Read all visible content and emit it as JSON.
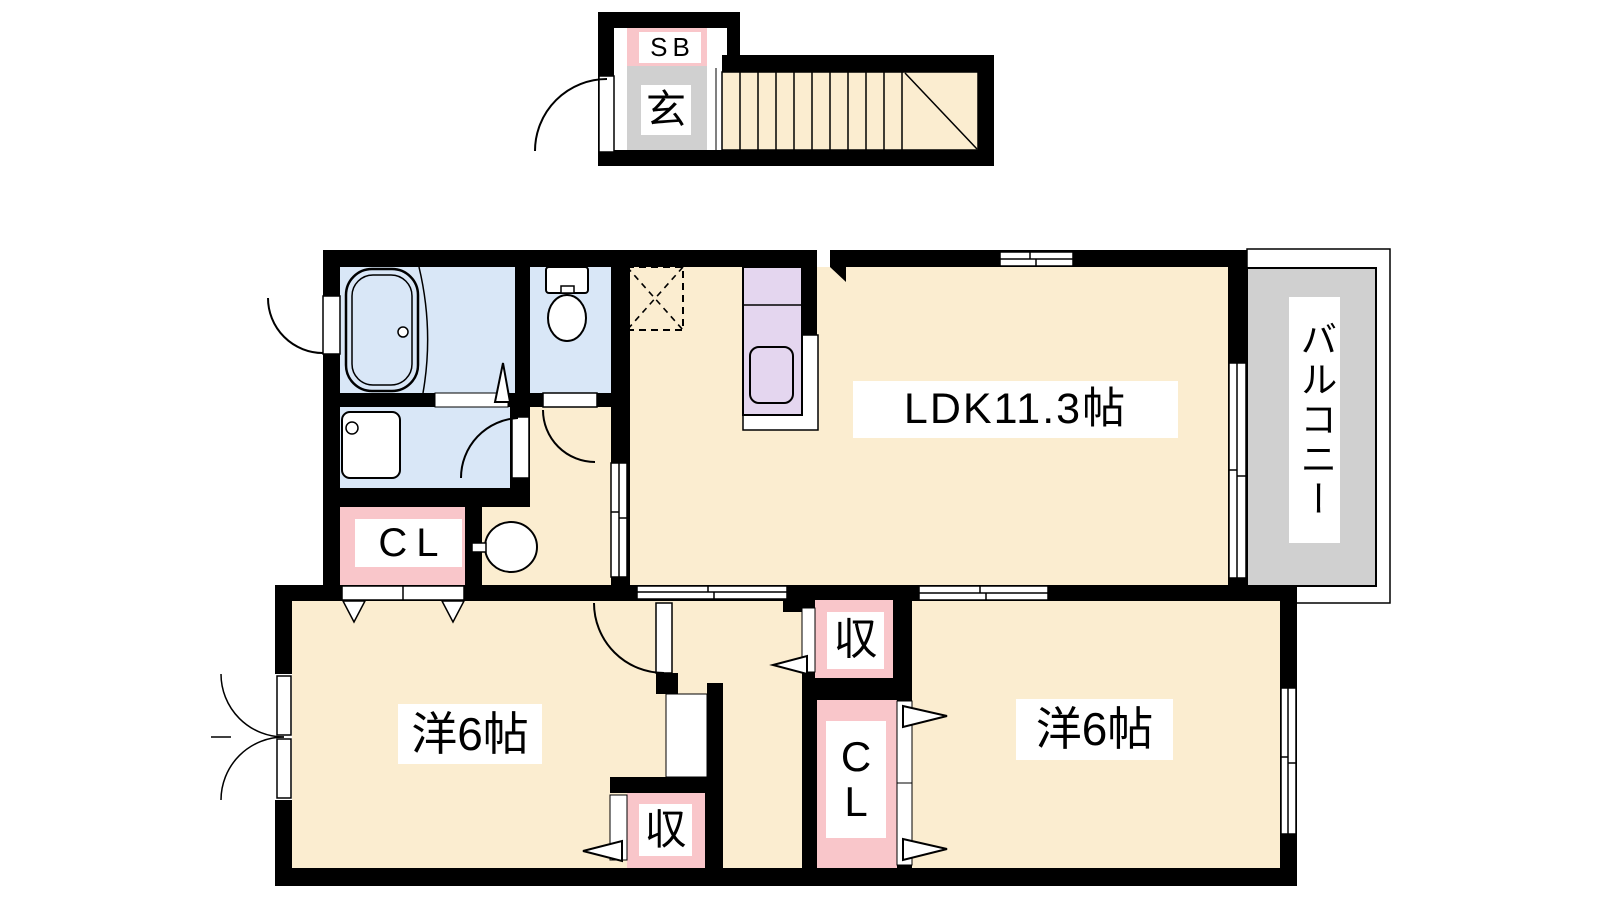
{
  "plan": {
    "title": "apartment floor plan (2LDK, 2nd floor with exterior staircase)",
    "rooms": {
      "shoe_box": {
        "label": "SB"
      },
      "entrance": {
        "label": "玄"
      },
      "ldk": {
        "label": "LDK11.3帖"
      },
      "balcony": {
        "label": "バルコニー"
      },
      "closet_hall": {
        "label": "CL"
      },
      "bedroom_west": {
        "label": "洋6帖"
      },
      "bedroom_east": {
        "label": "洋6帖"
      },
      "storage_mid": {
        "label": "収"
      },
      "storage_south": {
        "label": "収"
      },
      "closet_east": {
        "label": "C\nL"
      }
    },
    "colors": {
      "bg": "#FFFFFF",
      "wall": "#000000",
      "floor": "#FBEDD0",
      "wet": "#D9E7F7",
      "pink": "#F9C6CA",
      "gray": "#D0D0D0",
      "purple": "#E4D6EF"
    },
    "fixtures": [
      "staircase",
      "entrance-door",
      "bathtub",
      "toilet",
      "washstand",
      "wash-basin",
      "kitchen-counter",
      "kitchen-sink",
      "refrigerator-space",
      "sliding-windows",
      "sliding-doors",
      "hinged-doors",
      "bifold-closet-doors"
    ]
  }
}
